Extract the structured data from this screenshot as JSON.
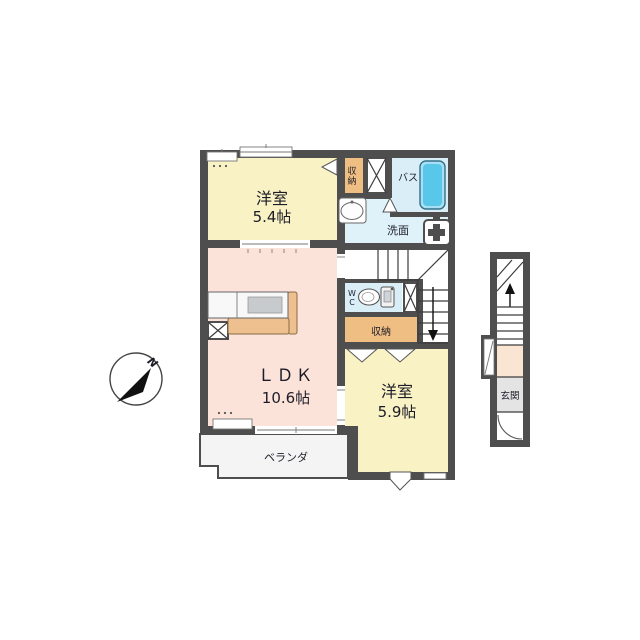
{
  "compass": {
    "north_label": "N"
  },
  "rooms": {
    "bedroom_top": {
      "name": "洋室",
      "size": "5.4帖"
    },
    "ldk": {
      "name": "ＬＤＫ",
      "size": "10.6帖"
    },
    "bedroom_bottom": {
      "name": "洋室",
      "size": "5.9帖"
    },
    "closet_top": {
      "char1": "収",
      "char2": "納"
    },
    "closet_mid": {
      "label": "収納"
    },
    "bath": {
      "label": "バス"
    },
    "washroom": {
      "label": "洗面"
    },
    "wc": {
      "char1": "W",
      "char2": "C"
    },
    "veranda": {
      "label": "ベランダ"
    },
    "entrance": {
      "label": "玄関"
    }
  },
  "colors": {
    "wall": "#4e4e4e",
    "bedroom": "#f9f2c4",
    "ldk": "#fce3da",
    "closet": "#efbe82",
    "wet": "#daeef8",
    "bathtub": "#58c7ea",
    "kitchen": "#eec08f",
    "veranda": "#f4f4f4",
    "entrance_floor": "#e4e4e4",
    "entrance_hall": "#fae5d2"
  }
}
